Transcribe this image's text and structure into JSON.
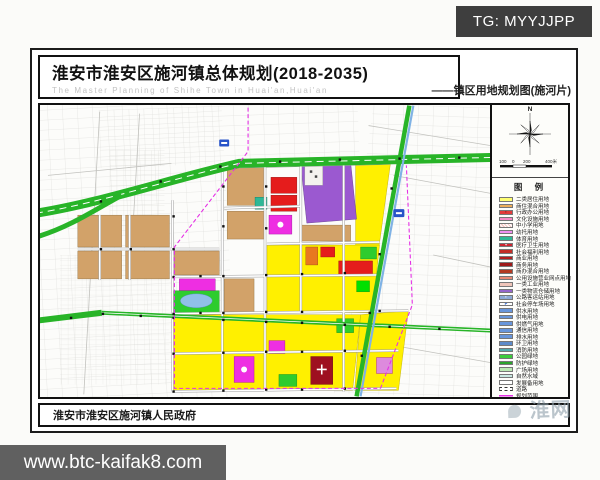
{
  "overlay": {
    "tg_label": "TG: MYYJJPP",
    "url_label": "www.btc-kaifak8.com"
  },
  "header": {
    "title": "淮安市淮安区施河镇总体规划(2018-2035)",
    "subtitle": "The Master Planning of Shihe Town in Huai'an,Huai'an",
    "map_label": "——镇区用地规划图(施河片)"
  },
  "sidebar": {
    "north_label": "N",
    "scale_labels": [
      "100",
      "0",
      "200",
      "400米"
    ],
    "legend_title": "图 例",
    "legend": [
      {
        "label": "二类居住用地",
        "color": "#FFFF72",
        "pattern": "solid"
      },
      {
        "label": "商住混合用地",
        "color": "#EDAE5A",
        "pattern": "solid"
      },
      {
        "label": "行政办公用地",
        "color": "#E23A3A",
        "pattern": "solid",
        "glyph": "▪",
        "glyph_color": "#7a0c0c"
      },
      {
        "label": "文化设施用地",
        "color": "#F589C4",
        "pattern": "solid"
      },
      {
        "label": "中小学用地",
        "color": "#F6C6C2",
        "pattern": "hatch"
      },
      {
        "label": "幼托用地",
        "color": "#EF8FEF",
        "pattern": "solid"
      },
      {
        "label": "体育用地",
        "color": "#2FB896",
        "pattern": "solid"
      },
      {
        "label": "医疗卫生用地",
        "color": "#CE2430",
        "pattern": "solid",
        "glyph": "+",
        "glyph_color": "#ffffff"
      },
      {
        "label": "社会福利用地",
        "color": "#C22D26",
        "pattern": "solid"
      },
      {
        "label": "商业用地",
        "color": "#B31F1F",
        "pattern": "solid"
      },
      {
        "label": "商务用地",
        "color": "#9E1A1A",
        "pattern": "solid"
      },
      {
        "label": "商办混合用地",
        "color": "#B33A22",
        "pattern": "solid"
      },
      {
        "label": "公用设施营业网点用地",
        "color": "#E98A76",
        "pattern": "solid"
      },
      {
        "label": "一类工业用地",
        "color": "#EFC4B8",
        "pattern": "solid"
      },
      {
        "label": "一类物流仓储用地",
        "color": "#9465CB",
        "pattern": "solid"
      },
      {
        "label": "公路客运站用地",
        "color": "#8CA9D6",
        "pattern": "solid",
        "glyph": "▪",
        "glyph_color": "#ffffff"
      },
      {
        "label": "社会停车场用地",
        "color": "#FFFFFF",
        "pattern": "solid",
        "glyph": "P",
        "glyph_color": "#1a57c8"
      },
      {
        "label": "供水用地",
        "color": "#6795DB",
        "pattern": "solid"
      },
      {
        "label": "供电用地",
        "color": "#6795DB",
        "pattern": "solid"
      },
      {
        "label": "供燃气用地",
        "color": "#6795DB",
        "pattern": "solid"
      },
      {
        "label": "通信用地",
        "color": "#6795DB",
        "pattern": "solid"
      },
      {
        "label": "排水用地",
        "color": "#6795DB",
        "pattern": "solid"
      },
      {
        "label": "环卫用地",
        "color": "#5C8BCB",
        "pattern": "solid"
      },
      {
        "label": "消防用地",
        "color": "#53A9AD",
        "pattern": "solid"
      },
      {
        "label": "公园绿地",
        "color": "#3BCB3B",
        "pattern": "solid"
      },
      {
        "label": "防护绿地",
        "color": "#2BA52B",
        "pattern": "solid"
      },
      {
        "label": "广场用地",
        "color": "#BBE9B3",
        "pattern": "solid"
      },
      {
        "label": "自然水域",
        "color": "#C9E9E2",
        "pattern": "solid"
      },
      {
        "label": "发展备用地",
        "color": "#FFFFFF",
        "pattern": "solid"
      },
      {
        "label": "道路",
        "color": "#555555",
        "pattern": "road"
      },
      {
        "label": "规划范围",
        "color": "#E531E5",
        "pattern": "line"
      }
    ]
  },
  "footer": {
    "government": "淮安市淮安区施河镇人民政府",
    "watermark": "淮网"
  },
  "palette": {
    "res-yellow": "#FFF000",
    "mix-tan": "#D2A269",
    "warehouse-purple": "#9B59D0",
    "commercial-red": "#E51C1C",
    "culture-magenta": "#EE2EE2",
    "culture-violet": "#DD8ADD",
    "park-green": "#2ECC2E",
    "road-green": "#28B428",
    "canal-blue": "#7FB2E5",
    "pond-blue": "#90C0E8",
    "hospital-red": "#9E1020",
    "sport-teal": "#2FB896",
    "orange-block": "#E87820",
    "boundary-magenta": "#E531E5"
  }
}
